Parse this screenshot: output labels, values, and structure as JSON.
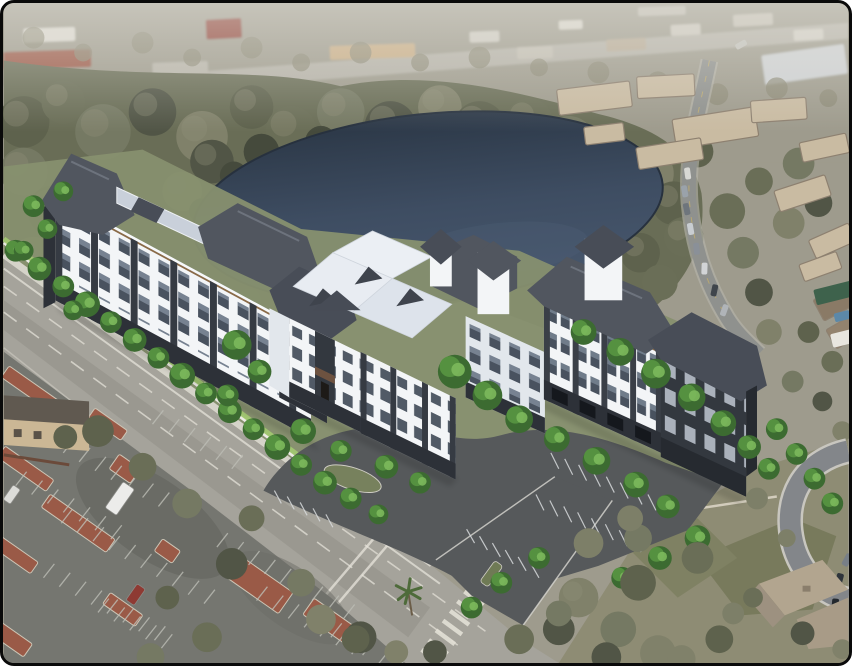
{
  "scene": {
    "type": "architectural-aerial-rendering",
    "description": "Aerial rendering of a proposed four-story white and charcoal apartment community with dark hip roofs beside a dark pond, fronted by a diagonal arterial road, an existing parking lot with terracotta planting islands, tan condo buildings and a winding road to the northeast, and a single-family house with cul-de-sac at the lower right."
  },
  "palette": {
    "frame": "#0a0a0a",
    "page_bg": "#ffffff",
    "distant_base": "#9e9b8d",
    "distant_road": "#b5b2a8",
    "distant_road2": "#aeaba0",
    "olive_cycle": [
      "#5e624d",
      "#6a6e57",
      "#757963",
      "#515546",
      "#80816a"
    ],
    "olive_underlay": "#696d56",
    "olive_light": "#8e8f77",
    "olive_dark": "#454a3c",
    "pond_top": "#2c3847",
    "pond_mid": "#3e4d62",
    "pond_low": "#48586e",
    "pond_sheen": "#4d5e75",
    "tree_dark": "#3c6b31",
    "tree_mid": "#559140",
    "tree_light": "#7cb95c",
    "hedge": "#a5cc71",
    "road": "#a5a39b",
    "road_dark": "#908e86",
    "marking": "#e3e0d6",
    "sidewalk": "#d9d7ce",
    "wall": "#ecebe5",
    "asphalt_new": "#56595b",
    "asphalt_old": "#757670",
    "stripe_new": "#d8dbdd",
    "stripe_old": "#bdbeb6",
    "island": "#9a5a47",
    "island_curb": "#cdc6b6",
    "bldg_white": "#f3f5f7",
    "bldg_shade": "#e2e7ec",
    "bldg_charcoal": "#33383f",
    "bldg_base": "#2d3138",
    "roof_dark": "#51565f",
    "roof_dark2": "#484d57",
    "roof_light": "#c9d0da",
    "roof_white": "#ebeff4",
    "fascia": "#8a6a48",
    "site_green": "#87906f",
    "tan_wall": "#cbb795",
    "tan_roof": "#605950",
    "condo_wall": "#c9bba2",
    "condo_roof": "#8d8070",
    "grass": "#75785a",
    "grass2": "#7f8163",
    "house_roof": "#b2a58f",
    "house_roof2": "#9d9180",
    "house_wing": "#a89b87",
    "culdesac": "#83868a",
    "green_roof": "#3e624c",
    "pool": "#5c88a8"
  },
  "scene_items": {
    "distant_buildings": [
      [
        46,
        32,
        52,
        14,
        -2,
        "#dcd9d0"
      ],
      [
        44,
        57,
        88,
        18,
        -2,
        "#9c5a48"
      ],
      [
        178,
        66,
        56,
        13,
        -2,
        "#b8b5aa"
      ],
      [
        222,
        26,
        36,
        20,
        -3,
        "#8e4036"
      ],
      [
        372,
        49,
        86,
        14,
        -2,
        "#c9ad85"
      ],
      [
        485,
        34,
        30,
        11,
        -2,
        "#cfccc2"
      ],
      [
        536,
        50,
        36,
        12,
        -2,
        "#c2beb2"
      ],
      [
        572,
        22,
        24,
        9,
        -2,
        "#d8d5ca"
      ],
      [
        628,
        42,
        40,
        12,
        -3,
        "#b8ab96"
      ],
      [
        688,
        27,
        30,
        11,
        -3,
        "#ccc8bd"
      ],
      [
        756,
        17,
        40,
        12,
        -3,
        "#c4c0b4"
      ],
      [
        812,
        32,
        30,
        11,
        -3,
        "#d2cfc5"
      ],
      [
        664,
        8,
        48,
        9,
        -2,
        "#bfbbb0"
      ],
      [
        808,
        62,
        84,
        30,
        -8,
        "#ced1d3"
      ]
    ],
    "olive_blobs": [
      [
        30,
        35,
        11,
        "#8a8874",
        0.7
      ],
      [
        80,
        50,
        9,
        "#8a8874",
        0.7
      ],
      [
        140,
        40,
        11,
        "#8a8874",
        0.7
      ],
      [
        190,
        55,
        9,
        "#8a8874",
        0.7
      ],
      [
        250,
        45,
        11,
        "#8a8874",
        0.7
      ],
      [
        300,
        60,
        9,
        "#8a8874",
        0.7
      ],
      [
        360,
        50,
        11,
        "#8a8874",
        0.7
      ],
      [
        420,
        60,
        9,
        "#8a8874",
        0.7
      ],
      [
        480,
        55,
        11,
        "#8a8874",
        0.7
      ],
      [
        540,
        65,
        9,
        "#8a8874",
        0.7
      ],
      [
        600,
        70,
        11,
        "#8a8874",
        0.7
      ],
      [
        660,
        80,
        11,
        "#8a8874",
        0.7
      ],
      [
        720,
        92,
        11,
        "#8a8874",
        0.7
      ],
      [
        780,
        86,
        11,
        "#8a8874",
        0.7
      ],
      [
        832,
        96,
        9,
        "#8a8874",
        0.7
      ],
      [
        20,
        120,
        26
      ],
      [
        60,
        100,
        22
      ],
      [
        100,
        130,
        28
      ],
      [
        150,
        110,
        24
      ],
      [
        200,
        135,
        26
      ],
      [
        250,
        105,
        22
      ],
      [
        290,
        130,
        26
      ],
      [
        340,
        110,
        24
      ],
      [
        390,
        125,
        26
      ],
      [
        440,
        105,
        22
      ],
      [
        480,
        125,
        26
      ],
      [
        530,
        120,
        24
      ],
      [
        570,
        140,
        26
      ],
      [
        610,
        152,
        24
      ],
      [
        650,
        172,
        26
      ],
      [
        676,
        202,
        22
      ],
      [
        686,
        236,
        20
      ],
      [
        20,
        170,
        24
      ],
      [
        50,
        210,
        26
      ],
      [
        30,
        260,
        24
      ],
      [
        60,
        300,
        22
      ],
      [
        40,
        350,
        20
      ],
      [
        25,
        395,
        18
      ],
      [
        210,
        160,
        22
      ],
      [
        180,
        190,
        20
      ],
      [
        642,
        252,
        20
      ],
      [
        662,
        282,
        18
      ],
      [
        602,
        300,
        16
      ],
      [
        362,
        300,
        13
      ],
      [
        420,
        306,
        11
      ],
      [
        302,
        310,
        13
      ],
      [
        248,
        300,
        12
      ],
      [
        560,
        308,
        13
      ],
      [
        260,
        150,
        18,
        "#454a3c"
      ],
      [
        320,
        140,
        16,
        "#454a3c"
      ],
      [
        400,
        134,
        18,
        "#454a3c"
      ],
      [
        480,
        144,
        16,
        "#454a3c"
      ],
      [
        556,
        158,
        18,
        "#454a3c"
      ],
      [
        618,
        184,
        14,
        "#454a3c"
      ],
      [
        232,
        174,
        14,
        "#454a3c"
      ],
      [
        200,
        210,
        13,
        "#454a3c"
      ],
      [
        730,
        210,
        18
      ],
      [
        746,
        252,
        16
      ],
      [
        762,
        292,
        14
      ],
      [
        772,
        332,
        13
      ],
      [
        700,
        150,
        16
      ],
      [
        762,
        180,
        14
      ],
      [
        802,
        162,
        16
      ],
      [
        822,
        202,
        14
      ],
      [
        792,
        222,
        16
      ],
      [
        812,
        332,
        11
      ],
      [
        836,
        362,
        11
      ],
      [
        796,
        382,
        11
      ],
      [
        826,
        402,
        10
      ],
      [
        846,
        432,
        10
      ]
    ],
    "olive_fg": [
      [
        95,
        432,
        16
      ],
      [
        140,
        468,
        14
      ],
      [
        185,
        505,
        15
      ],
      [
        230,
        566,
        16
      ],
      [
        320,
        622,
        15
      ],
      [
        62,
        438,
        12
      ],
      [
        250,
        520,
        13
      ],
      [
        300,
        585,
        14
      ],
      [
        360,
        640,
        16
      ],
      [
        396,
        655,
        12
      ],
      [
        165,
        600,
        12
      ],
      [
        205,
        640,
        15
      ],
      [
        148,
        660,
        14
      ],
      [
        435,
        655,
        12
      ],
      [
        580,
        600,
        20
      ],
      [
        640,
        585,
        18
      ],
      [
        700,
        560,
        16
      ],
      [
        620,
        632,
        18
      ],
      [
        560,
        632,
        16
      ],
      [
        660,
        656,
        18
      ],
      [
        722,
        642,
        14
      ],
      [
        756,
        600,
        10
      ],
      [
        640,
        540,
        14
      ],
      [
        608,
        660,
        15
      ],
      [
        684,
        662,
        14
      ],
      [
        355,
        642,
        14
      ],
      [
        520,
        642,
        15
      ],
      [
        560,
        616,
        13
      ],
      [
        590,
        545,
        15,
        "#7d7f68"
      ],
      [
        632,
        520,
        13,
        "#7d7f68"
      ],
      [
        760,
        500,
        11,
        "#7d7f68"
      ],
      [
        790,
        540,
        9,
        "#7d7f68"
      ],
      [
        736,
        616,
        11,
        "#7d7f68"
      ],
      [
        806,
        636,
        12
      ],
      [
        846,
        652,
        10
      ]
    ],
    "bright_trees": [
      [
        12,
        250,
        11
      ],
      [
        36,
        268,
        12
      ],
      [
        60,
        286,
        11
      ],
      [
        84,
        304,
        13
      ],
      [
        108,
        322,
        11
      ],
      [
        132,
        340,
        12
      ],
      [
        156,
        358,
        11
      ],
      [
        180,
        376,
        13
      ],
      [
        204,
        394,
        11
      ],
      [
        228,
        412,
        12
      ],
      [
        252,
        430,
        11
      ],
      [
        276,
        448,
        13
      ],
      [
        300,
        466,
        11
      ],
      [
        324,
        484,
        12
      ],
      [
        350,
        500,
        11
      ],
      [
        378,
        516,
        10
      ],
      [
        235,
        345,
        15
      ],
      [
        258,
        372,
        12
      ],
      [
        226,
        396,
        11
      ],
      [
        302,
        432,
        13
      ],
      [
        340,
        452,
        11
      ],
      [
        386,
        468,
        12
      ],
      [
        420,
        484,
        11
      ],
      [
        455,
        372,
        17
      ],
      [
        488,
        396,
        15
      ],
      [
        520,
        420,
        14
      ],
      [
        558,
        440,
        13
      ],
      [
        598,
        462,
        14
      ],
      [
        638,
        486,
        13
      ],
      [
        670,
        508,
        12
      ],
      [
        585,
        332,
        13
      ],
      [
        622,
        352,
        14
      ],
      [
        658,
        374,
        15
      ],
      [
        694,
        398,
        14
      ],
      [
        726,
        424,
        13
      ],
      [
        752,
        448,
        12
      ],
      [
        772,
        470,
        11
      ],
      [
        60,
        190,
        10
      ],
      [
        30,
        205,
        11
      ],
      [
        44,
        228,
        10
      ],
      [
        20,
        250,
        10
      ],
      [
        70,
        310,
        10
      ],
      [
        780,
        430,
        11
      ],
      [
        800,
        455,
        11
      ],
      [
        818,
        480,
        11
      ],
      [
        836,
        505,
        11
      ],
      [
        700,
        540,
        13
      ],
      [
        662,
        560,
        12
      ],
      [
        624,
        580,
        11
      ],
      [
        540,
        560,
        11
      ],
      [
        502,
        585,
        11
      ],
      [
        472,
        610,
        11
      ]
    ],
    "condos": [
      [
        596,
        96,
        74,
        26,
        -7
      ],
      [
        668,
        84,
        58,
        22,
        -3
      ],
      [
        718,
        126,
        84,
        30,
        -9
      ],
      [
        782,
        108,
        56,
        22,
        -4
      ],
      [
        828,
        146,
        48,
        20,
        -12
      ],
      [
        606,
        132,
        40,
        18,
        -7
      ],
      [
        672,
        152,
        66,
        22,
        -9
      ],
      [
        806,
        192,
        54,
        22,
        -18
      ],
      [
        836,
        240,
        44,
        20,
        -24
      ],
      [
        824,
        266,
        40,
        18,
        -20
      ],
      [
        838,
        302,
        36,
        24,
        -28,
        "#8a7a66"
      ],
      [
        848,
        332,
        30,
        22,
        -30,
        "#93836e"
      ]
    ],
    "right_road_cars": [
      [
        690,
        172,
        6,
        12,
        -8,
        "#d8d8d4"
      ],
      [
        687,
        190,
        6,
        12,
        -10,
        "#9aa2aa"
      ],
      [
        689,
        208,
        6,
        12,
        -12,
        "#6e757c"
      ],
      [
        693,
        228,
        6,
        12,
        -10,
        "#c9cdd1"
      ],
      [
        699,
        248,
        6,
        12,
        -6,
        "#8a9098"
      ],
      [
        707,
        268,
        6,
        12,
        2,
        "#d2d4d6"
      ],
      [
        717,
        290,
        6,
        12,
        12,
        "#3f454c"
      ],
      [
        727,
        310,
        6,
        12,
        20,
        "#b0b4b8"
      ],
      [
        744,
        42,
        12,
        6,
        -30,
        "#c2c2bc"
      ]
    ],
    "culdesac_cars": [
      [
        843,
        582,
        7,
        13,
        15,
        "#2e343b"
      ],
      [
        851,
        562,
        7,
        13,
        28,
        "#787f87"
      ],
      [
        839,
        607,
        7,
        12,
        5,
        "#23282e"
      ]
    ],
    "lot_vehicles": [
      [
        117,
        500,
        14,
        32,
        35,
        "#ececea"
      ],
      [
        133,
        597,
        10,
        20,
        35,
        "#8e3a33"
      ],
      [
        8,
        496,
        9,
        18,
        35,
        "#dcdcd8"
      ]
    ],
    "misc_rects": [
      [
        840,
        292,
        44,
        16,
        -14,
        "#3e624c"
      ],
      [
        846,
        316,
        16,
        9,
        -14,
        "#5c88a8"
      ],
      [
        848,
        338,
        26,
        14,
        -14,
        "#e8e6df"
      ],
      [
        812,
        568,
        18,
        8,
        -20,
        "#9a9a94"
      ]
    ],
    "islands": [
      [
        30,
        392,
        70,
        14,
        35
      ],
      [
        105,
        425,
        40,
        12,
        35
      ],
      [
        22,
        470,
        60,
        14,
        35
      ],
      [
        122,
        470,
        26,
        18,
        35
      ],
      [
        75,
        525,
        80,
        16,
        35
      ],
      [
        12,
        557,
        46,
        14,
        35
      ],
      [
        165,
        553,
        22,
        15,
        35
      ],
      [
        255,
        585,
        72,
        26,
        35
      ],
      [
        120,
        612,
        40,
        14,
        35
      ],
      [
        332,
        626,
        60,
        20,
        35
      ],
      [
        8,
        642,
        40,
        16,
        35
      ]
    ],
    "old_rows": [
      [
        28,
        436,
        9,
        16,
        9,
        11,
        -14
      ],
      [
        12,
        487,
        7,
        16,
        9,
        11,
        -14
      ],
      [
        58,
        525,
        10,
        16,
        9,
        11,
        -14
      ],
      [
        40,
        580,
        8,
        16,
        9,
        11,
        -14
      ],
      [
        150,
        425,
        6,
        16,
        9,
        11,
        -14
      ],
      [
        215,
        549,
        9,
        16,
        9,
        11,
        -14
      ],
      [
        255,
        603,
        7,
        16,
        9,
        11,
        -14
      ],
      [
        95,
        615,
        5,
        16,
        9,
        11,
        -14
      ],
      [
        330,
        640,
        5,
        16,
        9,
        11,
        -14
      ]
    ],
    "new_rows": [
      [
        560,
        470,
        8,
        14,
        6,
        -8,
        -16
      ],
      [
        545,
        512,
        8,
        14,
        6,
        -8,
        -16
      ],
      [
        475,
        545,
        6,
        13,
        7,
        -8,
        -14
      ],
      [
        280,
        505,
        5,
        13,
        6,
        -7,
        -13
      ]
    ],
    "fence_posts": [
      [
        14,
        252,
        12,
        27,
        19.5,
        0,
        -6
      ]
    ],
    "crosswalk": [
      [
        472,
        584,
        8,
        -7.2,
        9.8,
        19,
        14
      ]
    ]
  }
}
